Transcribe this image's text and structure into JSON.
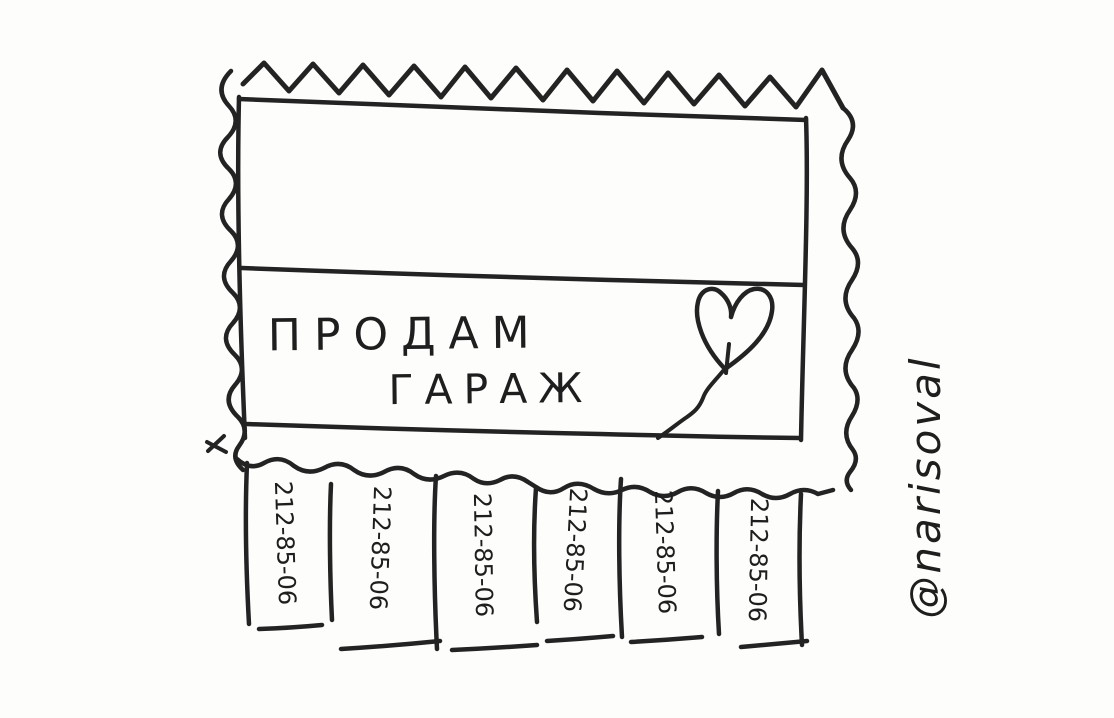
{
  "poster": {
    "title_line1": "ПРОДАМ",
    "title_line2": "ГАРАЖ",
    "phone": "212-85-06",
    "strips": [
      "212-85-06",
      "212-85-06",
      "212-85-06",
      "212-85-06",
      "212-85-06",
      "212-85-06"
    ]
  },
  "signature": "@narisoval",
  "icons": {
    "heart_balloon": "heart-balloon-icon"
  },
  "colors": {
    "ink": "#232323",
    "paper": "#fdfdfc"
  }
}
